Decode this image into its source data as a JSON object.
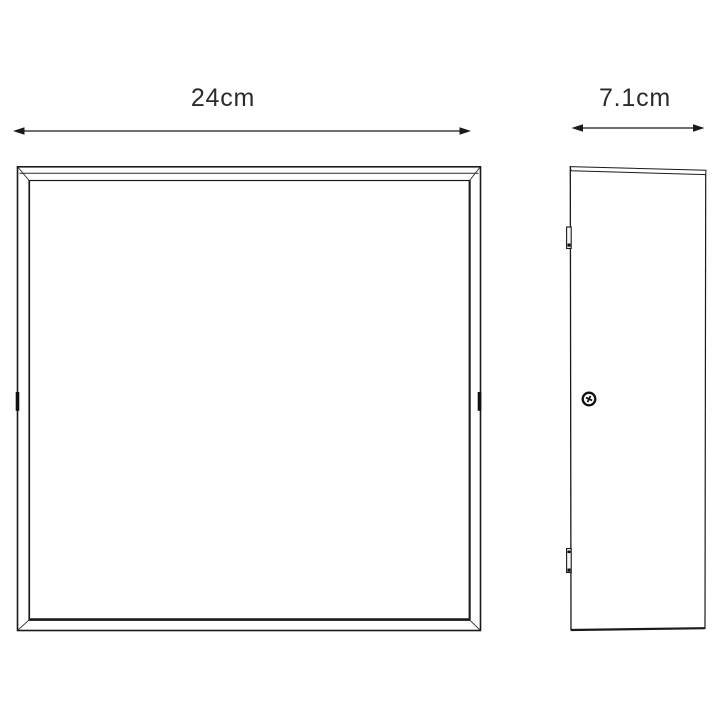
{
  "page": {
    "background_color": "#ffffff",
    "line_color": "#1a1a1a",
    "text_color": "#2b2b2b",
    "description": "Technical dimension drawing of a square flush-mount fixture, front view and side view"
  },
  "dimension_labels": {
    "front_width": "24cm",
    "side_depth": "7.1cm"
  },
  "icons": {
    "arrowhead": "dimension-arrowhead-icon",
    "screw": "screw-head-icon",
    "clip_top": "mounting-clip-top-icon",
    "clip_bottom": "mounting-clip-bottom-icon"
  }
}
